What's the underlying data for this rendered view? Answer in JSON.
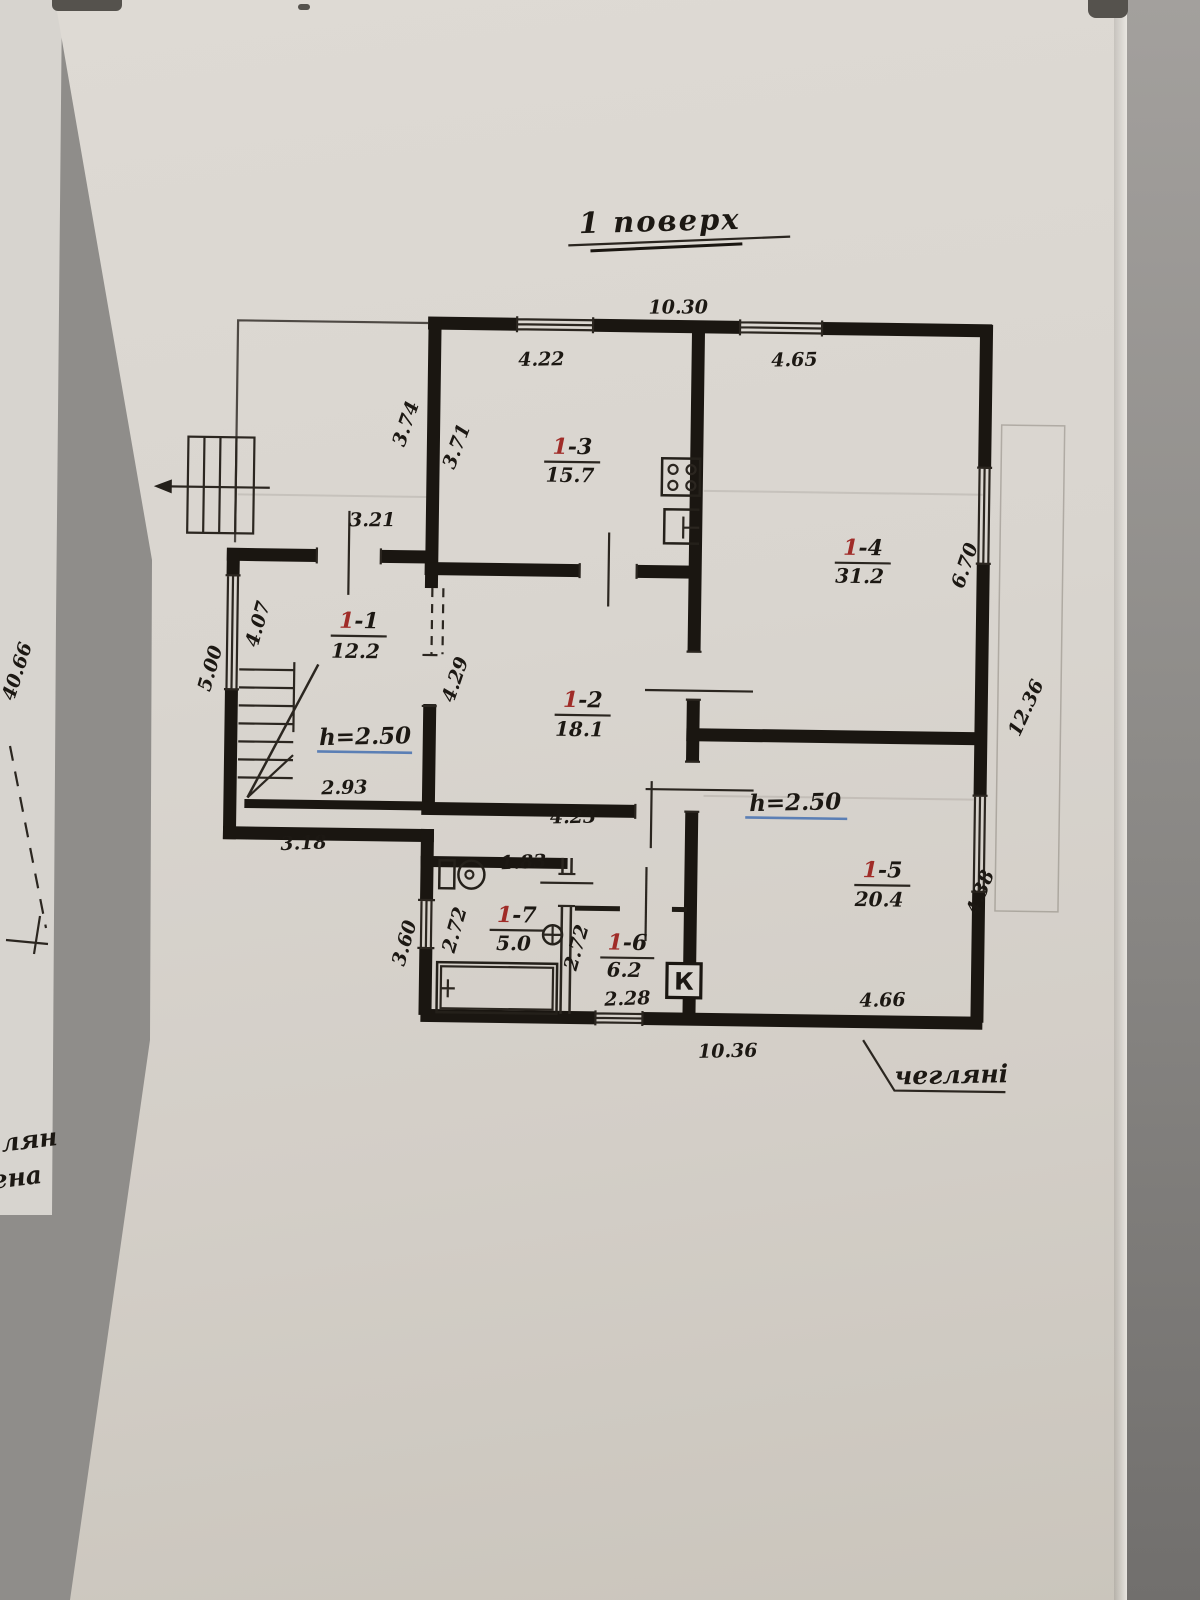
{
  "page": {
    "title": "1  поверх",
    "material_note": "чегляні",
    "h_left": "h=2.50",
    "h_right": "h=2.50",
    "edge_dim": "40.66",
    "edge_cut_1": "ілян",
    "edge_cut_2": "ена"
  },
  "rooms": [
    {
      "prefix": "1",
      "suffix": "-1",
      "area": "12.2"
    },
    {
      "prefix": "1",
      "suffix": "-2",
      "area": "18.1"
    },
    {
      "prefix": "1",
      "suffix": "-3",
      "area": "15.7"
    },
    {
      "prefix": "1",
      "suffix": "-4",
      "area": "31.2"
    },
    {
      "prefix": "1",
      "suffix": "-5",
      "area": "20.4"
    },
    {
      "prefix": "1",
      "suffix": "-6",
      "area": "6.2"
    },
    {
      "prefix": "1",
      "suffix": "-7",
      "area": "5.0"
    }
  ],
  "dims": {
    "top_overall": "10.30",
    "kitchen_width": "4.22",
    "room4_width": "4.65",
    "veranda_side": "3.74",
    "kitchen_left": "3.71",
    "entry_width": "3.21",
    "room1_left": "4.07",
    "left_side": "5.00",
    "room2_left": "4.29",
    "room4_right": "6.70",
    "right_overall": "12.36",
    "stair_width": "2.93",
    "left_bottom": "3.18",
    "room2_width": "4.23",
    "corridor_width": "1.83",
    "room7_left": "2.72",
    "room6_left": "2.72",
    "room6_width": "2.28",
    "bath_outer_left": "3.60",
    "room5_right": "4.38",
    "room5_width": "4.66",
    "bottom_overall": "10.36"
  },
  "symbols": {
    "boiler": "К"
  },
  "colors": {
    "ink": "#1c1813",
    "room_number_red": "#a02c28",
    "height_underline_blue": "#5b7fb5",
    "paper": "#d9d5cf"
  }
}
